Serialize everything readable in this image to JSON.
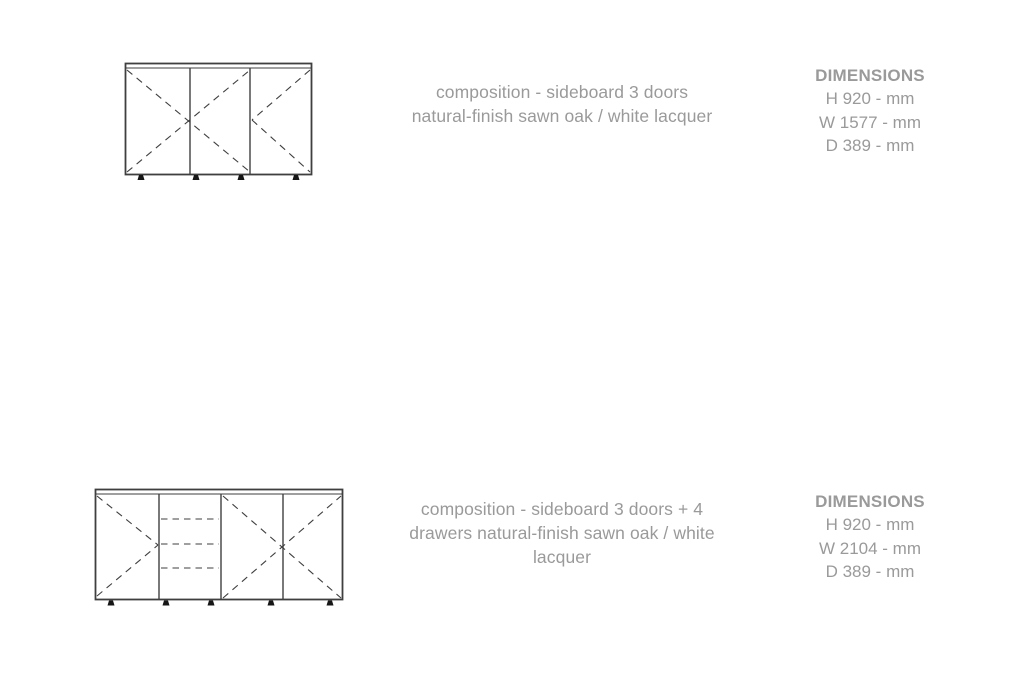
{
  "colors": {
    "background": "#ffffff",
    "text": "#9a9a9a",
    "drawing_line": "#3f3f3f",
    "feet": "#161616"
  },
  "products": [
    {
      "drawing": "sideboard-3-doors",
      "description_lines": [
        "composition - sideboard 3 doors",
        "natural-finish sawn oak / white lacquer"
      ],
      "dimensions": {
        "title": "DIMENSIONS",
        "height": "H 920 - mm",
        "width": "W 1577 - mm",
        "depth": "D 389 - mm"
      }
    },
    {
      "drawing": "sideboard-3-doors-4-drawers",
      "description_lines": [
        "composition - sideboard 3 doors + 4",
        "drawers natural-finish sawn oak / white",
        "lacquer"
      ],
      "dimensions": {
        "title": "DIMENSIONS",
        "height": "H 920 - mm",
        "width": "W 2104 - mm",
        "depth": "D 389 - mm"
      }
    }
  ]
}
